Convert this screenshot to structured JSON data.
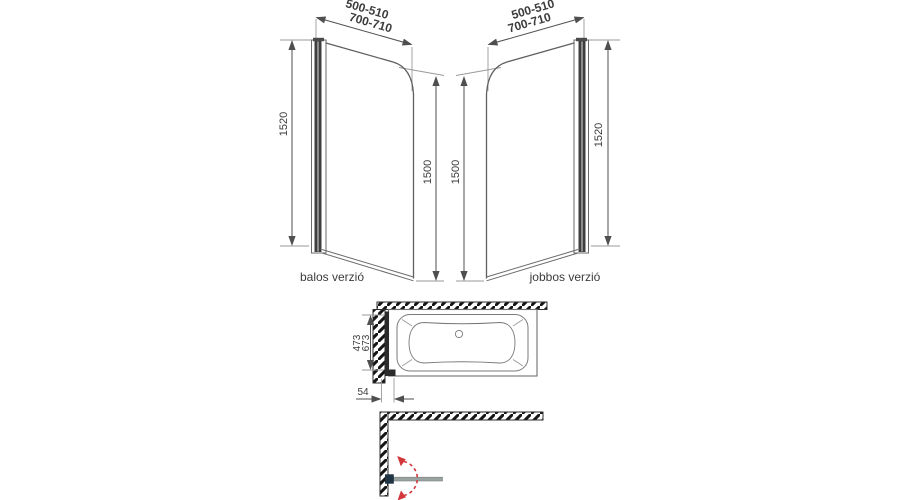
{
  "diagram": {
    "views": {
      "left": {
        "caption": "balos verzió",
        "width_range_1": "500-510",
        "width_range_2": "700-710",
        "frame_height": "1520",
        "glass_height": "1500"
      },
      "right": {
        "caption": "jobbos verzió",
        "width_range_1": "500-510",
        "width_range_2": "700-710",
        "frame_height": "1520",
        "glass_height": "1500"
      },
      "top": {
        "depth_dim_1": "473",
        "depth_dim_2": "673",
        "wall_offset": "54"
      }
    },
    "colors": {
      "dim_red": "#c43b3f",
      "dim_blue": "#5560b8",
      "dim_green": "#4fa24f",
      "swing_red": "#d2373c"
    }
  }
}
